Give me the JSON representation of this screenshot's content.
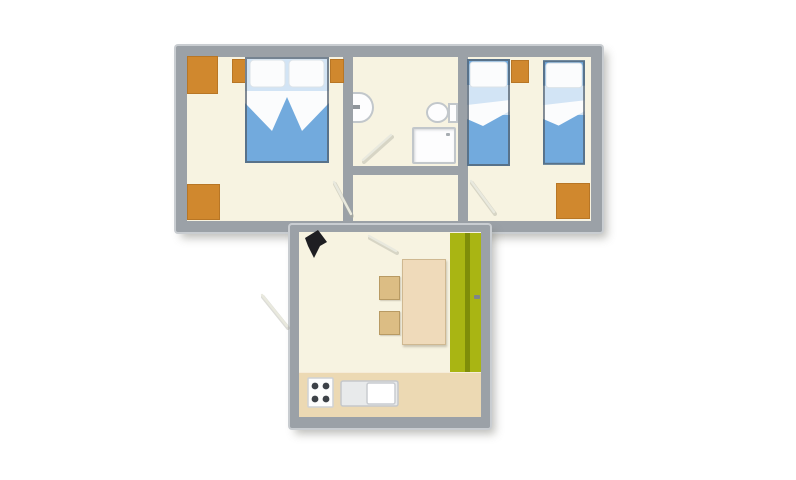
{
  "title": "apartment-floor-plan",
  "colors": {
    "background": "#ffffff",
    "wall": "#9ba1a7",
    "wall_edge": "#c9cdd1",
    "floor": "#f7f3e1",
    "orange": "#d0882e",
    "wood_table": "#efdaba",
    "wood_chair": "#dcbd84",
    "counter": "#ecd9b3",
    "green": "#a9b513",
    "green_dark": "#7f8d09",
    "bed_blue": "#72aadd",
    "bed_blue_light": "#d2e4f5",
    "bed_white": "#fbfcfd",
    "bed_outline": "#4d5a66",
    "fixture_fill": "#fdfdfe",
    "fixture_border": "#c2c7cb",
    "burner": "#3c4147",
    "arrow_black": "#1e1e22",
    "door_line": "#e9e9de",
    "door_shadow": "#a9a99d"
  },
  "rooms": [
    {
      "name": "double-bedroom",
      "furniture": [
        "wardrobe",
        "nightstand",
        "double-bed",
        "nightstand",
        "wardrobe"
      ]
    },
    {
      "name": "bathroom",
      "furniture": [
        "washbasin",
        "toilet",
        "shower-tray"
      ]
    },
    {
      "name": "hallway",
      "furniture": []
    },
    {
      "name": "twin-bedroom",
      "furniture": [
        "single-bed",
        "nightstand",
        "single-bed",
        "wardrobe"
      ]
    },
    {
      "name": "kitchen-living-room",
      "furniture": [
        "entrance-arrow",
        "dining-table",
        "chair",
        "chair",
        "balcony-door-strip",
        "kitchen-counter",
        "stove",
        "sink-unit"
      ]
    }
  ],
  "entrance": "kitchen-top-left"
}
